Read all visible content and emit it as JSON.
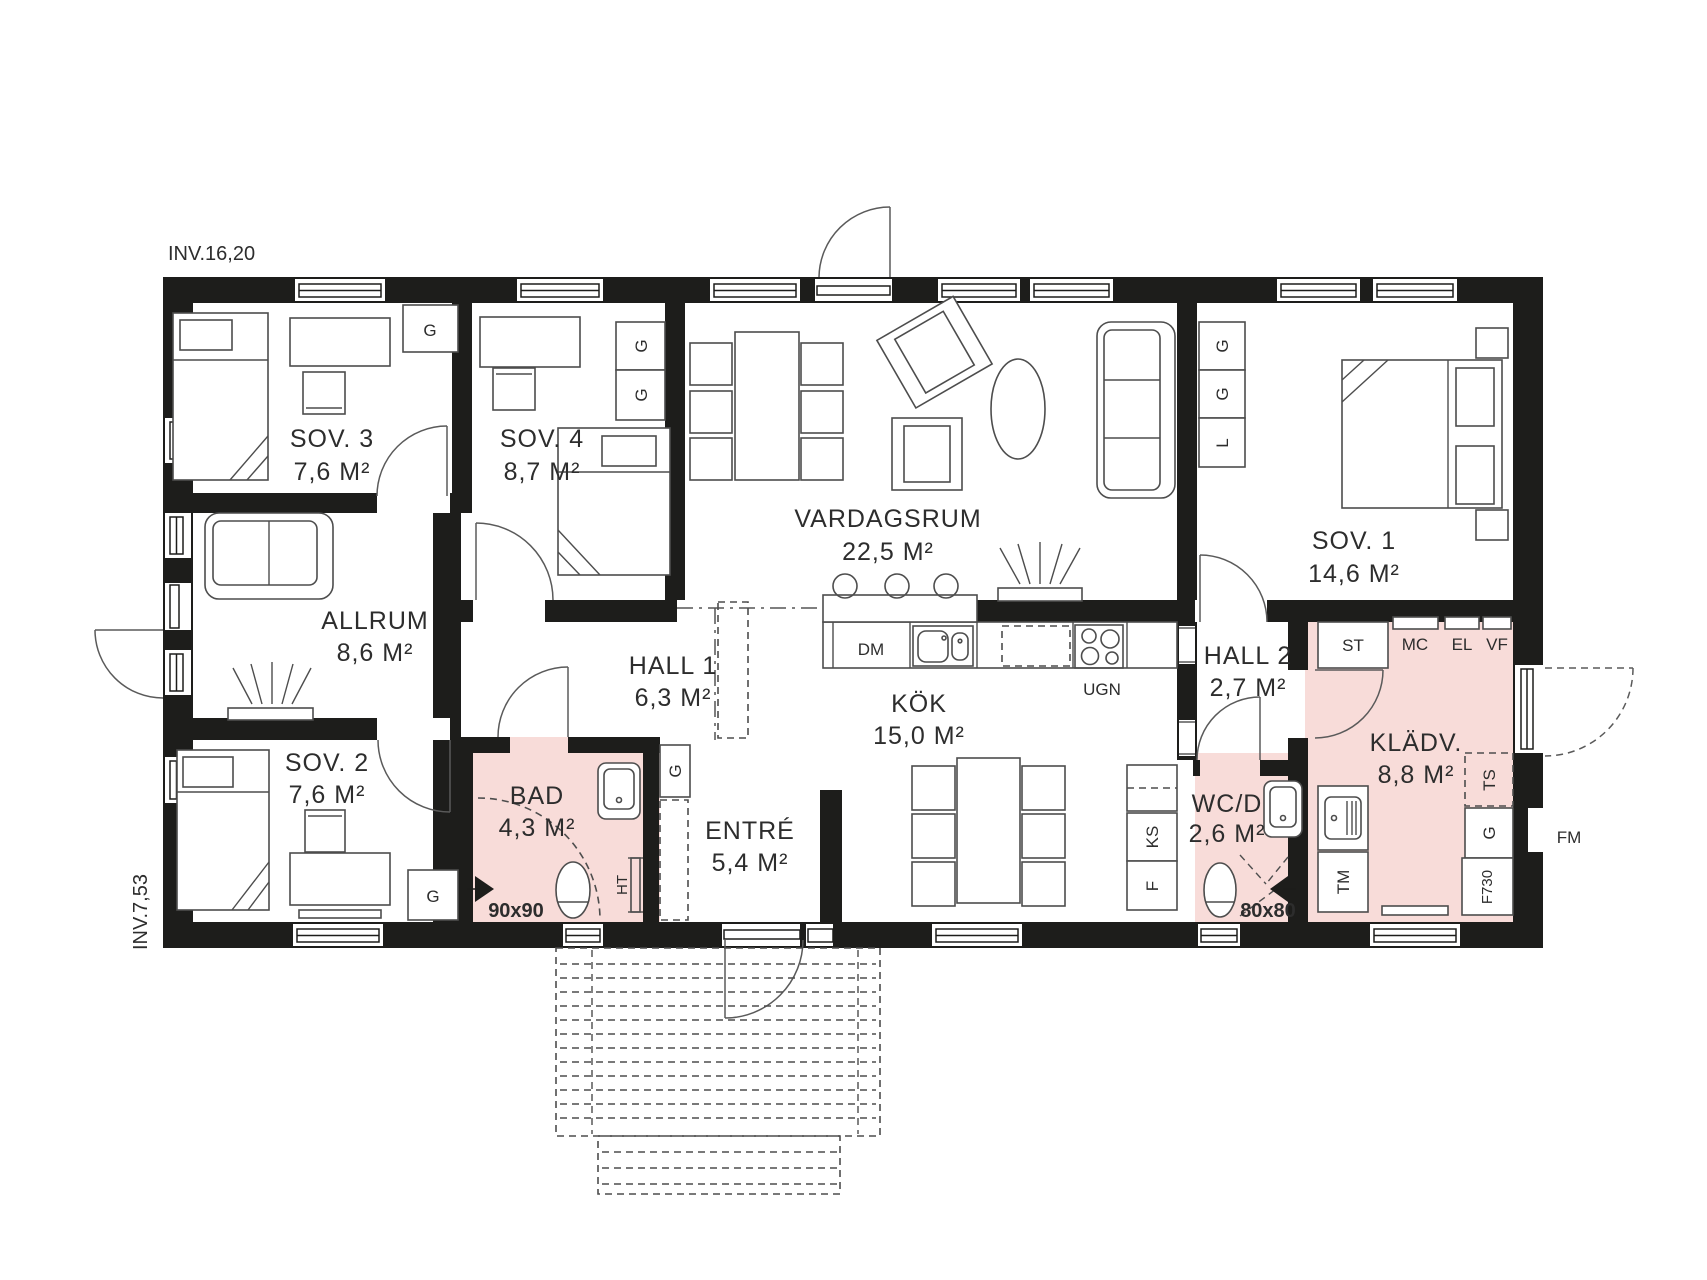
{
  "annotations": {
    "inv_top": "INV.16,20",
    "inv_left": "INV.7,53"
  },
  "rooms": {
    "sov3": {
      "name": "SOV. 3",
      "area": "7,6 M²"
    },
    "sov4": {
      "name": "SOV. 4",
      "area": "8,7 M²"
    },
    "vardagsrum": {
      "name": "VARDAGSRUM",
      "area": "22,5 M²"
    },
    "sov1": {
      "name": "SOV. 1",
      "area": "14,6 M²"
    },
    "allrum": {
      "name": "ALLRUM",
      "area": "8,6 M²"
    },
    "sov2": {
      "name": "SOV. 2",
      "area": "7,6 M²"
    },
    "bad": {
      "name": "BAD",
      "area": "4,3 M²"
    },
    "hall1": {
      "name": "HALL 1",
      "area": "6,3 M²"
    },
    "entre": {
      "name": "ENTRÉ",
      "area": "5,4 M²"
    },
    "kok": {
      "name": "KÖK",
      "area": "15,0 M²"
    },
    "hall2": {
      "name": "HALL 2",
      "area": "2,7 M²"
    },
    "wcd": {
      "name": "WC/D",
      "area": "2,6 M²"
    },
    "kladv": {
      "name": "KLÄDV.",
      "area": "8,8 M²"
    }
  },
  "fixtures": {
    "g": "G",
    "l": "L",
    "st": "ST",
    "mc": "MC",
    "el": "EL",
    "vf": "VF",
    "ts": "TS",
    "f730": "F730",
    "tm": "TM",
    "fm": "FM",
    "ks": "KS",
    "f": "F",
    "dm": "DM",
    "ugn": "UGN",
    "ht": "HT",
    "shower_bad": "90x90",
    "shower_wcd": "80x80"
  },
  "colors": {
    "wall": "#1d1d1b",
    "wet_room": "#f8dcd9",
    "line": "#4d4d4d"
  }
}
